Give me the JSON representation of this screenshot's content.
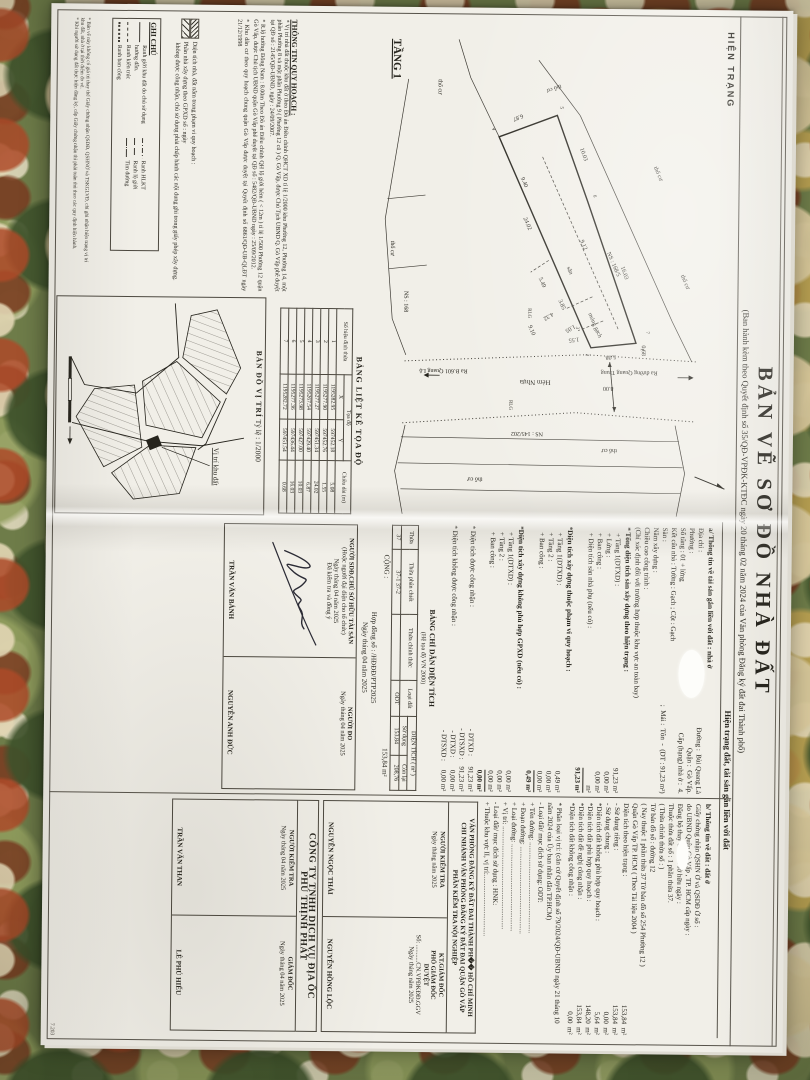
{
  "document": {
    "stamp": "HIỆN TRẠNG",
    "title": "BẢN VẼ SƠ ĐỒ NHÀ ĐẤT",
    "subtitle": "(Ban hành kèm theo Quyết định số 35/QĐ-VPĐK-KTĐC ngày 20 tháng 02 năm 2024 của Văn phòng Đăng ký đất đai Thành phố)",
    "status_band": "Hiện trạng đất, tài sản gắn liền với đất",
    "corner_note": "7.203"
  },
  "plan": {
    "labels": [
      {
        "x": 20,
        "y": 345,
        "s": 11,
        "b": 1,
        "u": 1,
        "t": "TẦNG 1"
      },
      {
        "x": 334,
        "y": 120,
        "r": 84,
        "s": 6,
        "t": "5.08"
      },
      {
        "x": 317,
        "y": 157,
        "r": 84,
        "s": 6,
        "t": "1.55"
      },
      {
        "x": 198,
        "y": 214,
        "r": -24,
        "s": 6,
        "t": "24.02"
      },
      {
        "x": 94,
        "y": 216,
        "r": 68,
        "s": 6,
        "t": "6.87"
      },
      {
        "x": 128,
        "y": 158,
        "r": -20,
        "s": 6,
        "t": "10.03"
      },
      {
        "x": 246,
        "y": 116,
        "r": -20,
        "s": 6,
        "t": "16.03"
      },
      {
        "x": 324,
        "y": 94,
        "r": 0,
        "s": 6,
        "t": "0.68"
      },
      {
        "x": 220,
        "y": 157,
        "r": -24,
        "s": 6,
        "t": "9.12"
      },
      {
        "x": 158,
        "y": 217,
        "r": -24,
        "s": 6,
        "t": "9.40"
      },
      {
        "x": 280,
        "y": 178,
        "r": -24,
        "s": 6,
        "t": "3.85"
      },
      {
        "x": 304,
        "y": 162,
        "r": 60,
        "s": 6,
        "t": "1.05"
      },
      {
        "x": 292,
        "y": 184,
        "r": 60,
        "s": 6,
        "t": "4.32"
      },
      {
        "x": 258,
        "y": 198,
        "r": -24,
        "s": 6,
        "t": "5.49"
      },
      {
        "x": 306,
        "y": 208,
        "r": -24,
        "s": 6,
        "t": "9.10"
      },
      {
        "x": 366,
        "y": 122,
        "r": 90,
        "s": 6,
        "t": "8.00"
      },
      {
        "x": 360,
        "y": 185,
        "r": 90,
        "s": 7,
        "t": "Hẻm Nhựa"
      },
      {
        "x": 350,
        "y": 78,
        "r": 90,
        "s": 6,
        "t": "Ra đường Quang Trung"
      },
      {
        "x": 350,
        "y": 268,
        "r": 90,
        "s": 6,
        "t": "Ra B.601 Quang Lộ"
      },
      {
        "x": 288,
        "y": 208,
        "s": 5,
        "t": "RLG"
      },
      {
        "x": 380,
        "y": 226,
        "s": 5,
        "t": "RLG"
      },
      {
        "x": 232,
        "y": 130,
        "r": -24,
        "s": 6,
        "t": "NS : 168/5"
      },
      {
        "x": 272,
        "y": 332,
        "s": 6,
        "t": "NS : 168"
      },
      {
        "x": 412,
        "y": 192,
        "r": 90,
        "s": 6,
        "t": "NS : 145/202"
      },
      {
        "x": 247,
        "y": 170,
        "r": -24,
        "s": 6,
        "t": "sân"
      },
      {
        "x": 293,
        "y": 148,
        "r": -24,
        "s": 6,
        "t": "móng gạch"
      },
      {
        "x": 146,
        "y": 84,
        "r": -24,
        "s": 6,
        "t": "thổ cư"
      },
      {
        "x": 64,
        "y": 178,
        "r": 70,
        "s": 6,
        "t": "thổ cư"
      },
      {
        "x": 222,
        "y": 346,
        "s": 6,
        "t": "thổ cư"
      },
      {
        "x": 428,
        "y": 118,
        "r": 90,
        "s": 6,
        "t": "thổ cư"
      },
      {
        "x": 458,
        "y": 252,
        "r": 90,
        "s": 6,
        "t": "thổ cư"
      },
      {
        "x": 254,
        "y": 56,
        "r": -24,
        "s": 6,
        "t": "thổ cư"
      },
      {
        "x": 60,
        "y": 300,
        "s": 6,
        "t": "thổ cư"
      },
      {
        "x": 327,
        "y": 95,
        "s": 5,
        "t": "1"
      },
      {
        "x": 333,
        "y": 150,
        "s": 5,
        "t": "2"
      },
      {
        "x": 306,
        "y": 160,
        "s": 5,
        "t": "3"
      },
      {
        "x": 108,
        "y": 246,
        "s": 5,
        "t": "4"
      },
      {
        "x": 86,
        "y": 178,
        "s": 5,
        "t": "5"
      },
      {
        "x": 174,
        "y": 144,
        "s": 5,
        "t": "6"
      },
      {
        "x": 310,
        "y": 90,
        "s": 5,
        "t": "7"
      }
    ]
  },
  "coord_table": {
    "title": "BẢNG LIỆT KÊ TỌA ĐỘ",
    "h_point": "Số hiệu đỉnh thửa",
    "h_coord": "Tọa độ",
    "h_x": "X",
    "h_y": "Y",
    "h_len": "Chiều dài (m)",
    "rows": [
      [
        "1",
        "1195282.95",
        "597452.18",
        "5.08"
      ],
      [
        "2",
        "1195277.90",
        "597452.76",
        "1.55"
      ],
      [
        "3",
        "1195277.27",
        "597451.34",
        "24.02"
      ],
      [
        "4",
        "1195267.54",
        "597429.40",
        "6.87"
      ],
      [
        "5",
        "1195273.98",
        "597427.00",
        "10.03"
      ],
      [
        "6",
        "1195277.36",
        "597436.44",
        "16.03"
      ],
      [
        "7",
        "1195282.72",
        "597451.54",
        "0.68"
      ]
    ]
  },
  "location_map": {
    "title": "BẢN ĐỒ VỊ TRÍ",
    "scale": "Tỷ lệ : 1/2000",
    "callout": "Vị trí khu đất"
  },
  "planning_info": {
    "header": "THÔNG TIN QUY HOẠCH :",
    "bullets": [
      "* Vị trí nhà đất thuộc khu đất ở theo Đồ án Điều chỉnh QHCT XD tỉ lệ 1/2000 khu Phường 12, Phường 14, một phần Phường 8 và một phần Phường 9 ( Phường 12 cũ ) Q. Gò Vấp, được Chủ Tịch UBND Q. Gò Vấp phê duyệt tại QĐ số : 2145/QĐ-UBND, ngày : 24/09/2007.",
      "* R.lộ hưởng Đông Nam : 8.00m Theo Đồ án Điều chỉnh QH lộ giới hẻm ( < 12m ) tỉ lệ 1/500 Phường 12 quận Gò Vấp, được Chủ tịch UBND quận Gò Vấp phê duyệt tại QĐ số : 5482/QĐ-UBND ngày : 25/09/2012.",
      "* Khu dân cư theo quy hoạch chung quận Gò Vấp được duyệt tại Quyết định số 6861/QĐ-UB-QLĐT ngày 21/12/1998"
    ]
  },
  "hatch_legend": {
    "l1": "Diện tích nhà, đất nằm trong phạm vi quy hoạch :",
    "l2": "Phần nhà xây dựng theo GPXD số :              ngày",
    "l3": "không được công nhận, chủ sử dụng phải chấp hành các nội dung ghi trong giấy phép xây dựng."
  },
  "notes_box": {
    "title": "GHI CHÚ",
    "left": [
      {
        "line": "solid",
        "label": "Ranh giới khu đất do chủ sử dụng hướng dẫn."
      },
      {
        "line": "dash",
        "label": "Ranh kiến trúc"
      },
      {
        "line": "dots",
        "label": "Ranh ban công"
      }
    ],
    "right": [
      {
        "line": "dashdot",
        "label": "Ranh HLKT"
      },
      {
        "line": "longdash",
        "label": "Ranh lộ giới"
      },
      {
        "line": "center",
        "label": "Tim đường"
      }
    ]
  },
  "fine_print": [
    "* Bản vẽ này không có giá trị thay thế Giấy chứng nhận QSDĐ, QSHNỞ và TSKGLVĐ, chỉ ghi nhận hiện trạng vị trí khu đất, nhà ở tại thời điểm đo vẽ.",
    "* Khi người sử dụng đất thực hiện đăng ký, cấp Giấy chứng nhận thì phải tuân thủ theo các quy định hiện hành."
  ],
  "section_a": {
    "header": "a/ Thông tin về tài sản gắn liền với đất : nhà ở",
    "lines": [
      {
        "l": "Địa chỉ :",
        "v": "Đường :  Bùi Quang Là"
      },
      {
        "l": "Phường :",
        "v": "Quận :  Gò Vấp."
      },
      {
        "l": "Số tầng :  01 + lửng",
        "v": "Cấp (hạng) nhà ở :  4."
      },
      "Kết cấu nhà :  Tường :  Gạch  ;  Cột :  Gạch",
      {
        "l": "Sàn :",
        "v": ";  Mái :  Tôn  -  (DT : 91,23 m²)"
      },
      "Năm xây dựng :",
      "Chiều cao công trình :",
      "(Chỉ xác định đối với trường hợp thuộc khu vực an toàn bay)"
    ],
    "floor_total_header": "* Tổng diện tích sàn xây dựng theo hiện trạng :",
    "floor_total": [
      {
        "l": "+ Tầng 1(DTXD) :",
        "v": "91,23 m²"
      },
      {
        "l": "+ Lửng :",
        "v": "0,00 m²"
      },
      {
        "l": "+ Ban công :",
        "v": "0,00 m²"
      },
      {
        "l": "+ Diện tích sàn nhà phụ (nếu có) :",
        "v": "m²"
      },
      {
        "l": "",
        "v": "91,23 m²",
        "cls": "total"
      }
    ],
    "qh_header": "*Diện tích xây dựng thuộc phạm vi quy hoạch :",
    "qh": [
      {
        "l": "+ Tầng 1(DTXD) :",
        "v": "0,49 m²"
      },
      {
        "l": "+ Tầng 2 :",
        "v": "0,00 m²"
      },
      {
        "l": "+ Ban công :",
        "v": "0,00 m²"
      },
      {
        "l": "",
        "v": "0,49 m²",
        "cls": "total"
      }
    ],
    "gpxd_header": "*Diện tích xây dựng không phù hợp GPXD (nếu có) :",
    "gpxd": [
      {
        "l": "+ Tầng 1(DTXD) :",
        "v": "0,00 m²"
      },
      {
        "l": "+ Tầng 2 :",
        "v": "0,00 m²"
      },
      {
        "l": "+ Ban công :",
        "v": "0,00 m²"
      },
      {
        "l": "",
        "v": "0,00 m²",
        "cls": "total"
      }
    ],
    "recognized": [
      {
        "l": "* Diện tích được công nhận :",
        "v": "- DTXD :      91,23 m²"
      },
      {
        "l": "",
        "v": "- DTSXD :    91,23 m²"
      },
      {
        "l": "* Diện tích không được công nhận :",
        "v": "- DTXD :       0,00 m²"
      },
      {
        "l": "",
        "v": "- DTSXD :     0,00 m²"
      }
    ]
  },
  "section_b": {
    "header": "b/ Thông tin về đất : đất ở",
    "lines": [
      "Giấy chứng nhận QSHN Ở và QSDĐ Ở số :",
      "do UBND Quận Gò Vấp , TP. HCM cấp ngày :",
      "Đăng bộ thay đổi chủ sở hữu ngày :",
      "Thuộc thửa đất số :   1 phần thửa 37.",
      "( Thửa chính thửa số :            )",
      "Tờ bản đồ số :            đường   12",
      "( Nay thuộc 1 phần thửa  37   Tờ bản đồ số  254   Phường  12 )",
      "Quận Gò Vấp   TP. HCM        ( Theo Tài liệu 2004 )",
      {
        "l": "Diện tích theo hiện trạng :",
        "v": "153,84  m²"
      },
      {
        "l": "- Sử dụng riêng :",
        "v": "153,84  m²"
      },
      {
        "l": "- Sử dụng chung :",
        "v": "0,00  m²"
      },
      {
        "l": "*Diện tích đất không phù hợp quy hoạch :",
        "v": "5,64  m²"
      },
      {
        "l": "*Diện tích đất phù hợp quy hoạch :",
        "v": "148,20  m²"
      },
      {
        "l": "*Diện tích đất đề nghị công nhận :",
        "v": "153,84  m²"
      },
      {
        "l": "*Diện tích đất không công nhận :",
        "v": "0,00  m²"
      }
    ],
    "classification": [
      "* Phân loại vị trí: (căn cứ Quyết định số 79/2024/QĐ-UBND ngày 21 tháng 10 năm 2024 của Ủy ban nhân dân TP.HCM)",
      "- Loại đất/ mục đích sử dụng: ODT:",
      "+ Tên đường: ....................................................",
      "+ Đoạn đường: ..................................................",
      "+ Loại đường: ..................................................",
      "+ Vị trí: ...........................................................",
      "- Loại đất/ mục đích sử dụng : HNK:",
      "+ Thuộc khu vực II, vị trí:..................................."
    ]
  },
  "area_table": {
    "title": "BẢNG CHỈ DẪN DIỆN TÍCH",
    "subtitle": "(Hệ tọa độ VN 2000)",
    "h_thua": "Thửa",
    "h_phanchiet": "Thửa phân chiết",
    "h_chinhthuc": "Thửa chính thức",
    "h_loaidat": "Loại đất",
    "h_dientich": "DIỆN TÍCH ( m² )",
    "h_sudung": "Sử dụng",
    "h_conlai": "Còn lại",
    "row": {
      "thua": "37",
      "phanchiet": "37-1   37-2",
      "chinhthuc": "",
      "loaidat": "ODT",
      "sudung": "153,84",
      "conlai": "208,76"
    },
    "footer_label": "CỘNG :",
    "footer_value": "153,84 m²"
  },
  "contract": {
    "no": "Hợp đồng số :      /HĐĐĐ/PTP2025",
    "date": "Ngày       tháng 04 năm 2025"
  },
  "signatures": {
    "owner": {
      "h1": "NGƯỜI SDĐ,CHỦ SỞ HỮU TÀI SẢN",
      "h2": "(Hoặc người đại diện cho tổ chức)",
      "h3": "Ngày       tháng 04 năm 2025",
      "h4": "Đã kiểm tra và đồng ý",
      "name": "TRẦN VĂN BÁNH"
    },
    "surveyor": {
      "h1": "NGƯỜI ĐO",
      "h3": "Ngày       tháng 04 năm 2025",
      "name": "NGUYỄN ANH ĐỨC"
    },
    "office": {
      "head1": "VĂN PHÒNG ĐĂNG KÝ ĐẤT ĐAI THÀNH PH�� HỒ CHÍ MINH",
      "head2": "CHI NHÁNH VĂN PHÒNG ĐĂNG KÝ ĐẤT ĐAI QUẬN GÒ VẤP",
      "head3": "PHẦN KIỂM TRA NỘI NGHIỆP",
      "checker": {
        "h1": "NGƯỜI KIỂM TRA",
        "h3": "Ngày       tháng       năm 2025",
        "name": "NGUYỄN NGỌC THÁI"
      },
      "director": {
        "h1": "KT.GIÁM ĐỐC",
        "h2": "PHÓ GIÁM ĐỐC",
        "h3": "DUYỆT",
        "h4": "Số: ...........CN.VPĐKĐĐ.GGV",
        "h5": "Ngày       tháng       năm 2025",
        "name": "NGUYỄN HỒNG LỘC"
      }
    },
    "company": {
      "head1": "CÔNG TY TNHH DỊCH VỤ ĐỊA ỐC",
      "head2": "PHÚ THỊNH PHÁT",
      "checker": {
        "h1": "NGƯỜI KIỂM TRA",
        "h3": "Ngày       tháng 04 năm 2025",
        "name": "TRẦN VĂN THAN"
      },
      "director": {
        "h1": "GIÁM ĐỐC",
        "h3": "Ngày       tháng 04 năm 2025",
        "name": "LÊ PHÚ HIẾU"
      }
    }
  }
}
